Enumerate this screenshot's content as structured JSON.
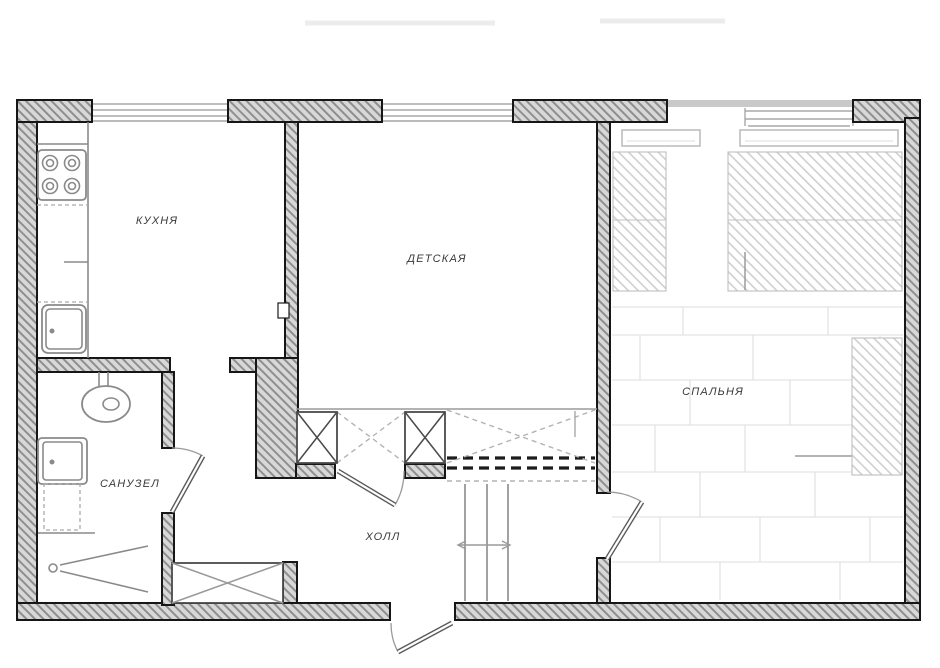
{
  "floor_plan": {
    "labels": {
      "kitchen": "КУХНЯ",
      "nursery": "ДЕТСКАЯ",
      "bedroom": "СПАЛЬНЯ",
      "bathroom": "САНУЗЕЛ",
      "hall": "ХОЛЛ"
    },
    "colors": {
      "wall_fill": "#d8d8d8",
      "wall_hatch_line": "#8f8f8f",
      "wall_outline": "#161616",
      "fixture_line": "#8a8a8a",
      "dash_color": "#b3b3b3",
      "label_text": "#3a3a3a"
    }
  }
}
